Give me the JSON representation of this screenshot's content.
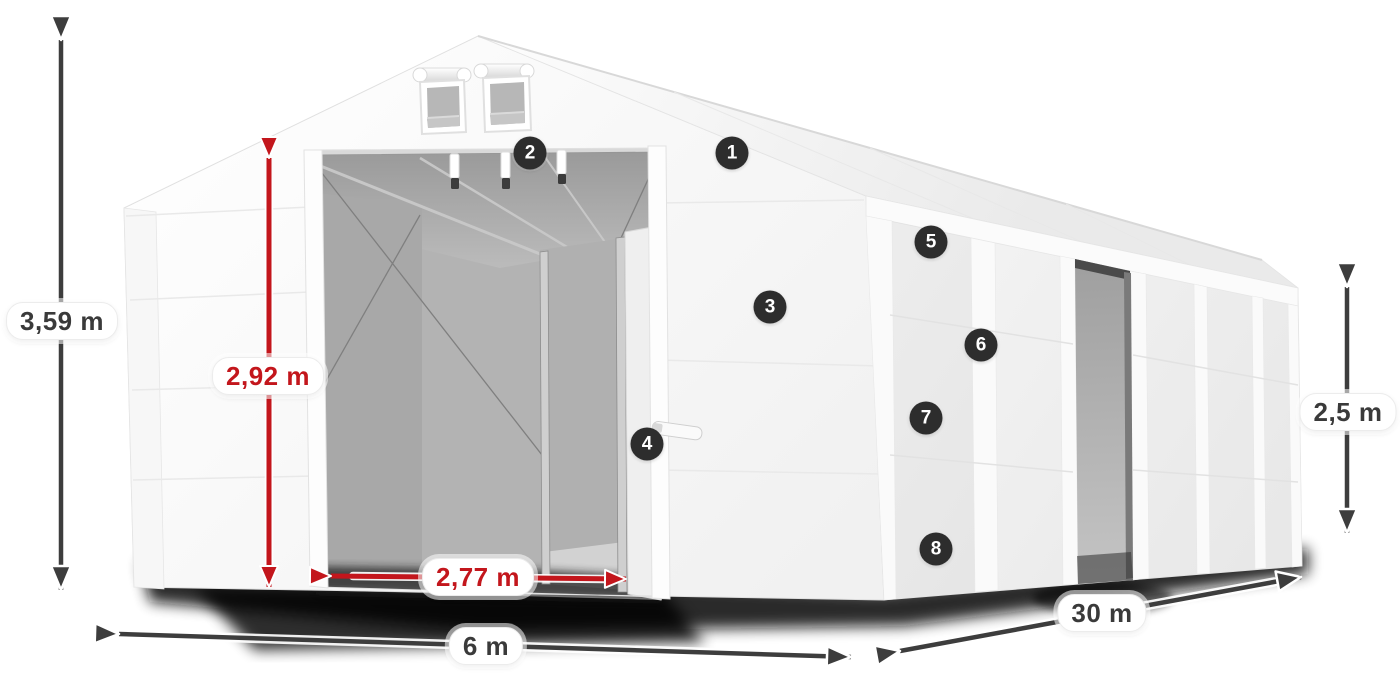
{
  "colors": {
    "canvas_bg": "#ffffff",
    "dim_dark": "#3d3d3d",
    "dim_red": "#c3161c",
    "badge_bg": "#2d2d2d",
    "badge_text": "#ffffff",
    "pill_bg": "#ffffff",
    "pill_text_dark": "#3a3a3a"
  },
  "dimensions": {
    "total_height": {
      "label": "3,59 m"
    },
    "entrance_height": {
      "label": "2,92 m"
    },
    "entrance_width": {
      "label": "2,77 m"
    },
    "span_width": {
      "label": "6 m"
    },
    "length": {
      "label": "30 m"
    },
    "side_height": {
      "label": "2,5 m"
    }
  },
  "markers": [
    {
      "label": "1"
    },
    {
      "label": "2"
    },
    {
      "label": "3"
    },
    {
      "label": "4"
    },
    {
      "label": "5"
    },
    {
      "label": "6"
    },
    {
      "label": "7"
    },
    {
      "label": "8"
    }
  ]
}
